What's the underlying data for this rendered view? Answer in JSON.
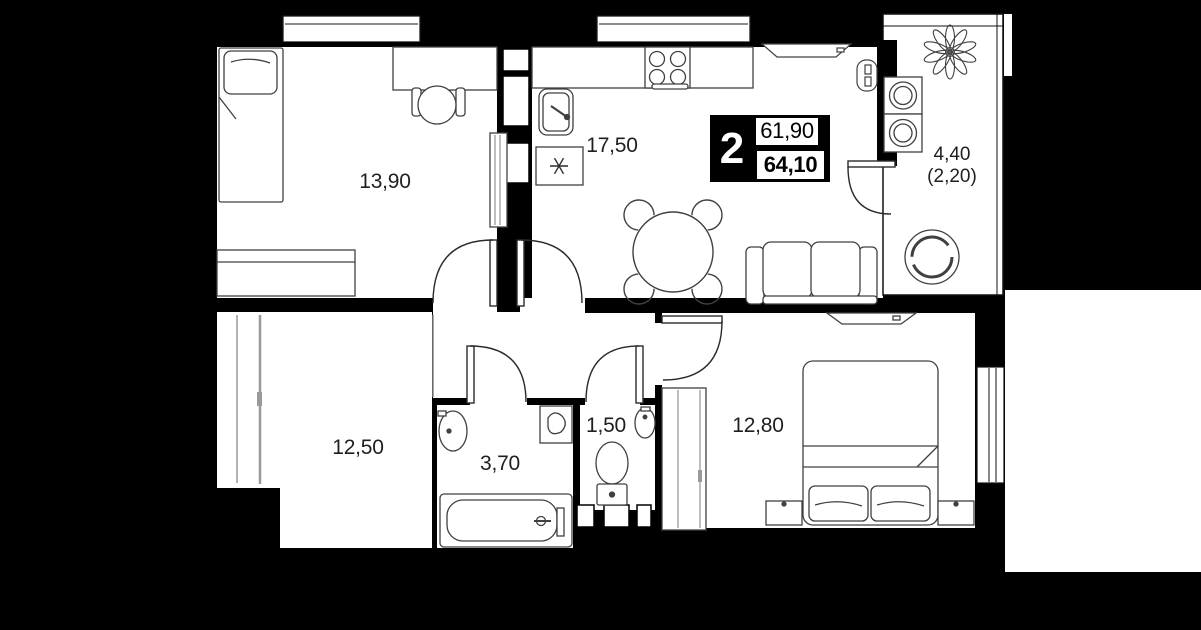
{
  "plan": {
    "title": "2-room apartment floor plan",
    "colors": {
      "background": "#000000",
      "floor": "#ffffff",
      "wall": "#000000",
      "furniture_line": "#404040",
      "text": "#1f1f1f"
    },
    "badge": {
      "rooms": "2",
      "area_living": "61,90",
      "area_total": "64,10"
    },
    "rooms": [
      {
        "name": "bedroom-1",
        "area": "13,90"
      },
      {
        "name": "kitchen-living",
        "area": "17,50"
      },
      {
        "name": "balcony",
        "area": "4,40",
        "area_secondary": "(2,20)"
      },
      {
        "name": "room-2",
        "area": "12,50"
      },
      {
        "name": "bathroom",
        "area": "3,70"
      },
      {
        "name": "wc",
        "area": "1,50"
      },
      {
        "name": "bedroom-2",
        "area": "12,80"
      }
    ]
  }
}
